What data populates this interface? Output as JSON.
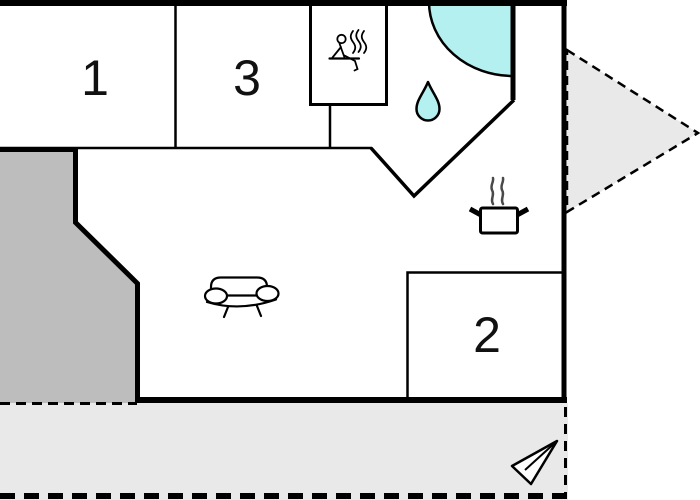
{
  "plan": {
    "type": "floor-plan",
    "labels": {
      "room1": "1",
      "room2": "2",
      "room3": "3"
    },
    "areas": {
      "room1_name": "room-1",
      "room2_name": "room-2",
      "room3_name": "room-3",
      "sauna_name": "sauna",
      "bathroom_name": "bathroom",
      "living_name": "living-area",
      "terrace_name": "terrace",
      "annex_name": "annex"
    },
    "icons": {
      "sauna": "sauna-icon",
      "water_drop": "water-drop-icon",
      "shower": "shower-corner",
      "cooking_pot": "cooking-pot-icon",
      "sofa": "sofa-icon",
      "arrow": "direction-arrow-icon"
    },
    "colors": {
      "wall": "#000000",
      "water": "#b4f0f0",
      "terrace": "#e9e9e9",
      "annex": "#bdbdbd",
      "triangle": "#e9e9e9",
      "arrow_fill": "#fdfdfd",
      "steam": "#4a4a4a",
      "background": "#ffffff"
    }
  }
}
